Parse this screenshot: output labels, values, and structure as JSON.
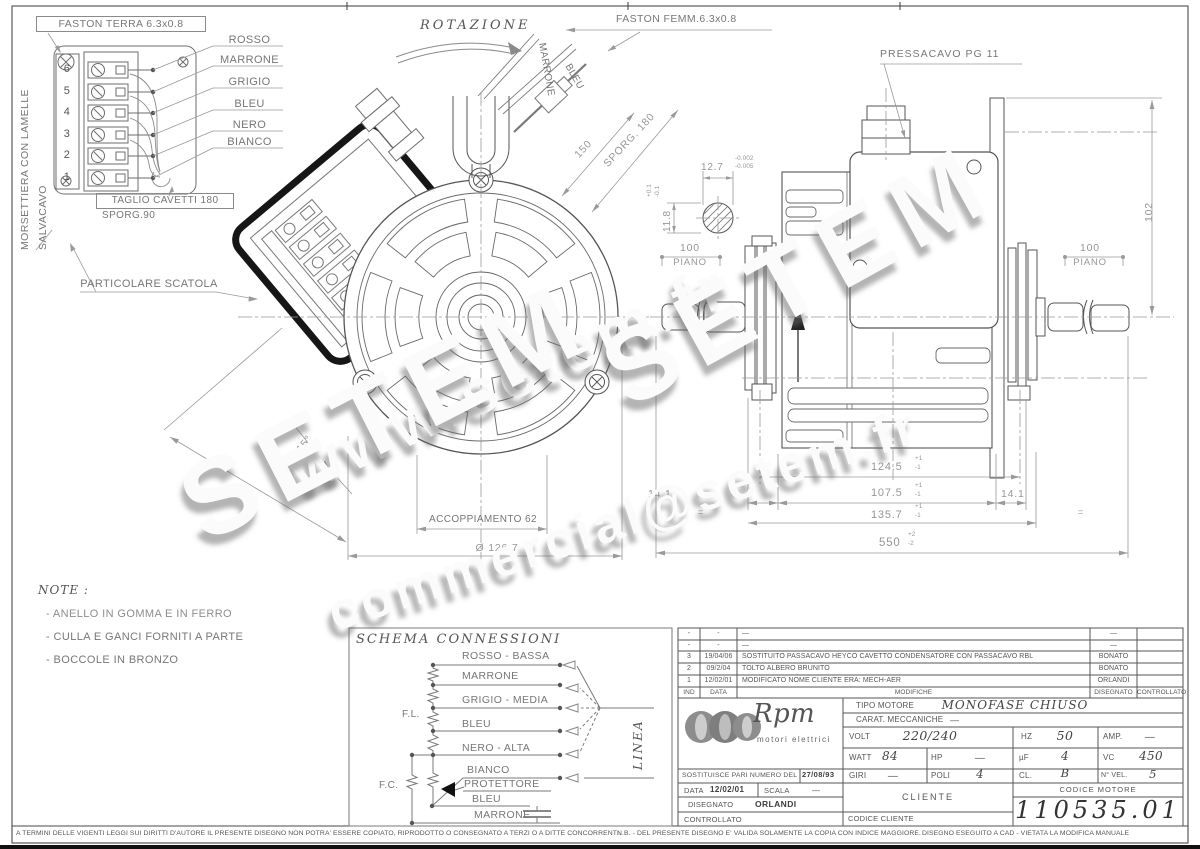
{
  "detail": {
    "title": "FASTON TERRA 6.3x0.8",
    "wire_labels": [
      "ROSSO",
      "MARRONE",
      "GRIGIO",
      "BLEU",
      "NERO",
      "BIANCO"
    ],
    "terminals": [
      "6",
      "5",
      "4",
      "3",
      "2",
      "1"
    ],
    "side_label_top": "MORSETTIERA CON LAMELLE",
    "side_label_bottom": "SALVACAVO",
    "cut_note": "TAGLIO CAVETTI 180",
    "cut_note2": "SPORG.90",
    "caption": "PARTICOLARE SCATOLA"
  },
  "front": {
    "rotation": "ROTAZIONE",
    "faston_femm": "FASTON FEMM.6.3x0.8",
    "wire_marrone": "MARRONE",
    "wire_bleu": "BLEU",
    "dim_150": "150",
    "dim_sporg": "SPORG. 180",
    "dim_angle": "15°",
    "dim_99": "99",
    "dim_accoppiamento": "ACCOPPIAMENTO 62",
    "dim_diameter": "Ø 126.7"
  },
  "shaft": {
    "dim_w": "12.7",
    "tol_w1": "-0.002",
    "tol_w2": "-0.005",
    "dim_h": "11.8",
    "tol_h1": "+0.1",
    "tol_h2": "-0.1"
  },
  "side": {
    "pressacavo": "PRESSACAVO PG 11",
    "dim_102": "102",
    "piano_dim": "100",
    "piano_label": "PIANO",
    "dim_124": "124.5",
    "dim_107": "107.5",
    "dim_141": "14.1",
    "dim_135": "135.7",
    "dim_550": "550",
    "tol_p1": "+1",
    "tol_m1": "-1",
    "tol_p2": "+2",
    "tol_m2": "-2",
    "eq": "="
  },
  "notes": {
    "title": "NOTE :",
    "items": [
      "- ANELLO IN GOMMA E IN FERRO",
      "- CULLA  E GANCI FORNITI A PARTE",
      "- BOCCOLE IN BRONZO"
    ]
  },
  "schema": {
    "title": "SCHEMA CONNESSIONI",
    "labels": [
      "ROSSO - BASSA",
      "MARRONE",
      "GRIGIO - MEDIA",
      "BLEU",
      "NERO - ALTA",
      "BIANCO",
      "PROTETTORE",
      "BLEU",
      "MARRONE"
    ],
    "fl": "F.L.",
    "fc": "F.C.",
    "linea": "LINEA"
  },
  "revisions": {
    "headers": [
      "IND",
      "DATA",
      "MODIFICHE",
      "DISEGNATO",
      "CONTROLLATO"
    ],
    "rows": [
      {
        "ind": "-",
        "data": "-",
        "mod": "—",
        "dis": "—",
        "ctl": ""
      },
      {
        "ind": "-",
        "data": "-",
        "mod": "—",
        "dis": "—",
        "ctl": ""
      },
      {
        "ind": "3",
        "data": "19/04/06",
        "mod": "SOSTITUITO PASSACAVO HEYCO CAVETTO CONDENSATORE CON PASSACAVO RBL",
        "dis": "BONATO",
        "ctl": ""
      },
      {
        "ind": "2",
        "data": "09/2/04",
        "mod": "TOLTO ALBERO BRUNITO",
        "dis": "BONATO",
        "ctl": ""
      },
      {
        "ind": "1",
        "data": "12/02/01",
        "mod": "MODIFICATO NOME CLIENTE ERA: MECH-AER",
        "dis": "ORLANDI",
        "ctl": ""
      }
    ]
  },
  "titleblock": {
    "logo": "Rpm",
    "logo_sub": "motori elettrici",
    "tipo_label": "TIPO MOTORE",
    "tipo_value": "MONOFASE CHIUSO",
    "carat_label": "CARAT. MECCANICHE",
    "carat_value": "—",
    "volt_label": "VOLT",
    "volt_value": "220/240",
    "hz_label": "HZ",
    "hz_value": "50",
    "amp_label": "AMP.",
    "amp_value": "—",
    "watt_label": "WATT",
    "watt_value": "84",
    "hp_label": "HP",
    "hp_value": "—",
    "uf_label": "µF",
    "uf_value": "4",
    "vc_label": "VC",
    "vc_value": "450",
    "giri_label": "GIRI",
    "giri_value": "—",
    "poli_label": "POLI",
    "poli_value": "4",
    "cl_label": "CL.",
    "cl_value": "B",
    "nvel_label": "N° VEL.",
    "nvel_value": "5",
    "sost_label": "SOSTITUISCE PARI NUMERO DEL",
    "sost_value": "27/08/93",
    "data_label": "DATA",
    "data_value": "12/02/01",
    "scala_label": "SCALA",
    "scala_value": "—",
    "disegnato_label": "DISEGNATO",
    "disegnato_value": "ORLANDI",
    "controllato_label": "CONTROLLATO",
    "cliente_label": "CLIENTE",
    "codcli_label": "CODICE CLIENTE",
    "codmot_label": "CODICE MOTORE",
    "codmot_value": "110535.01"
  },
  "legal": {
    "left": "A TERMINI DELLE VIGENTI LEGGI SUI DIRITTI D'AUTORE IL PRESENTE DISEGNO NON POTRA' ESSERE COPIATO, RIPRODOTTO O CONSEGNATO A TERZI O A DITTE CONCORRENTI.",
    "nb": "N.B. - DEL PRESENTE DISEGNO E' VALIDA SOLAMENTE LA COPIA CON INDICE MAGGIORE.",
    "cad": "DISEGNO ESEGUITO A CAD - VIETATA LA MODIFICA MANUALE"
  },
  "watermark": {
    "w1": "www.setem.fr",
    "w2": "SETEM",
    "w3": "SETEM",
    "w4": "commercial@setem.fr"
  }
}
